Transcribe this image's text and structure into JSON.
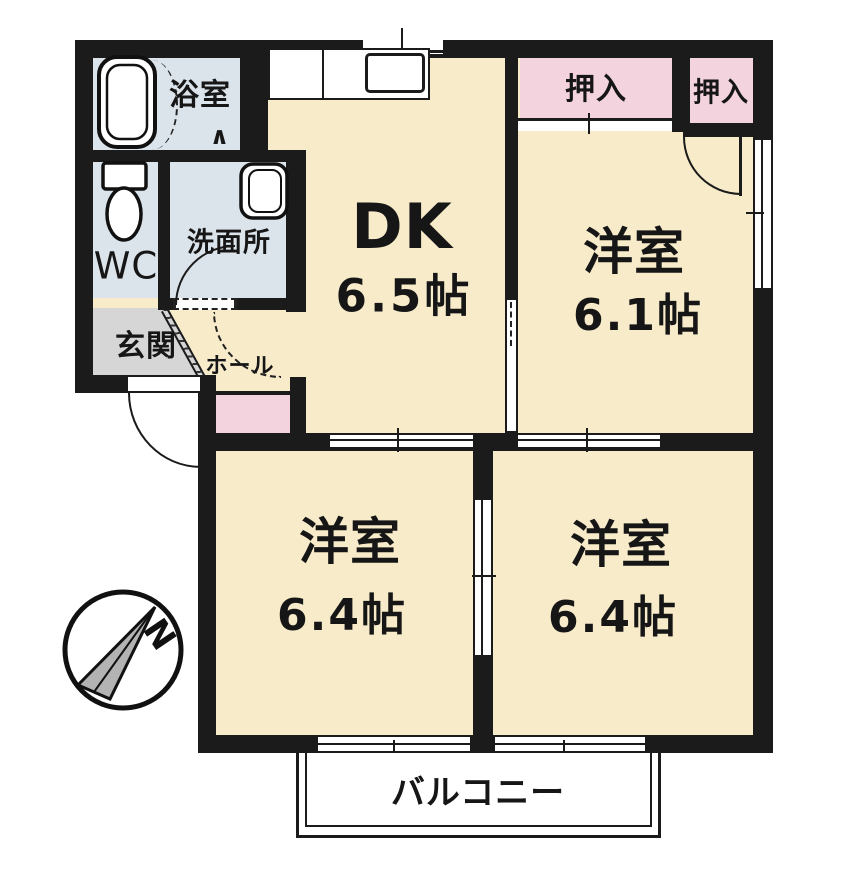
{
  "rooms": {
    "bath": {
      "label": "浴室"
    },
    "wc": {
      "label": "WC"
    },
    "washroom": {
      "label": "洗面所"
    },
    "entrance": {
      "label": "玄関"
    },
    "hall": {
      "label": "ホール"
    },
    "dk": {
      "label": "DK",
      "size": "6.5帖"
    },
    "closet_left": {
      "label": "押入"
    },
    "closet_right": {
      "label": "押入"
    },
    "bedroom_ne": {
      "label": "洋室",
      "size": "6.1帖"
    },
    "bedroom_sw": {
      "label": "洋室",
      "size": "6.4帖"
    },
    "bedroom_se": {
      "label": "洋室",
      "size": "6.4帖"
    },
    "balcony": {
      "label": "バルコニー"
    }
  },
  "compass": {
    "label": "N"
  },
  "symbols": {
    "folding_door": "∧"
  },
  "colors": {
    "room_floor": "#f7ebc9",
    "wet_area": "#dce4eb",
    "closet": "#f3d3de",
    "entrance_floor": "#d6d6d6",
    "wall": "#1b1b1b",
    "balcony": "#ffffff"
  }
}
